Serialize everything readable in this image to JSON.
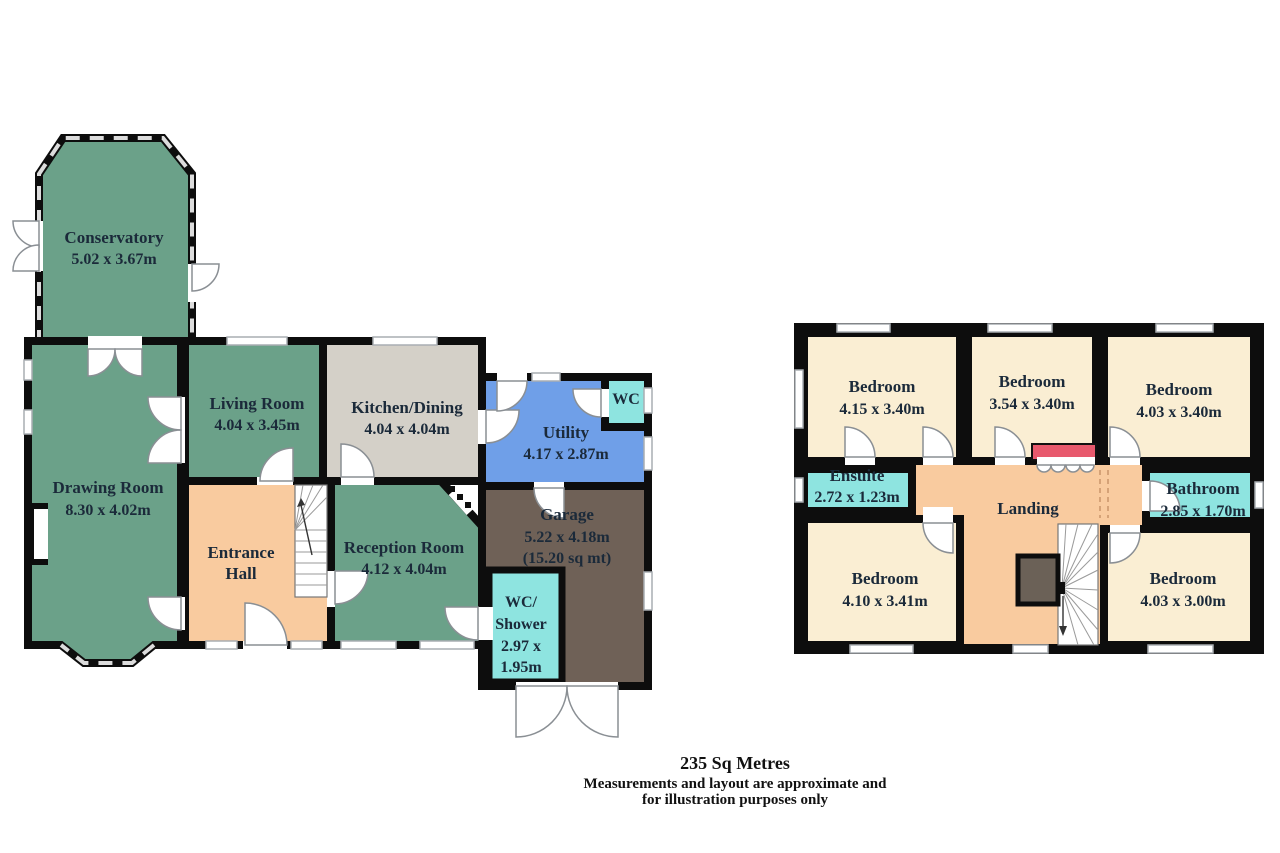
{
  "footer": {
    "area_total": "235 Sq Metres",
    "disclaimer_line1": "Measurements and layout are approximate and",
    "disclaimer_line2": "for illustration purposes only"
  },
  "ground_floor": {
    "conservatory": {
      "name": "Conservatory",
      "dims": "5.02 x 3.67m"
    },
    "drawing_room": {
      "name": "Drawing Room",
      "dims": "8.30 x 4.02m"
    },
    "living_room": {
      "name": "Living Room",
      "dims": "4.04 x 3.45m"
    },
    "kitchen_dining": {
      "name": "Kitchen/Dining",
      "dims": "4.04 x 4.04m"
    },
    "utility": {
      "name": "Utility",
      "dims": "4.17 x 2.87m"
    },
    "wc": {
      "name": "WC"
    },
    "entrance_hall": {
      "name_line1": "Entrance",
      "name_line2": "Hall"
    },
    "reception_room": {
      "name": "Reception Room",
      "dims": "4.12 x 4.04m"
    },
    "garage": {
      "name": "Garage",
      "dims": "5.22 x 4.18m",
      "area": "(15.20 sq mt)"
    },
    "wc_shower": {
      "name_line1": "WC/",
      "name_line2": "Shower",
      "dims_line1": "2.97 x",
      "dims_line2": "1.95m"
    }
  },
  "first_floor": {
    "bedroom_top_left": {
      "name": "Bedroom",
      "dims": "4.15 x 3.40m"
    },
    "bedroom_top_middle": {
      "name": "Bedroom",
      "dims": "3.54 x 3.40m"
    },
    "bedroom_top_right": {
      "name": "Bedroom",
      "dims": "4.03 x 3.40m"
    },
    "ensuite": {
      "name": "Ensuite",
      "dims": "2.72 x 1.23m"
    },
    "landing": {
      "name": "Landing"
    },
    "bathroom": {
      "name": "Bathroom",
      "dims": "2.85 x 1.70m"
    },
    "bedroom_bottom_left": {
      "name": "Bedroom",
      "dims": "4.10 x 3.41m"
    },
    "bedroom_bottom_right": {
      "name": "Bedroom",
      "dims": "4.03 x 3.00m"
    }
  },
  "colors": {
    "green": "#6ba189",
    "kitchen_gray": "#d4d0c8",
    "utility_blue": "#6f9fe8",
    "cyan": "#8ee4e0",
    "peach": "#f9cb9f",
    "garage_brown": "#6f6157",
    "bedroom_cream": "#faeed3",
    "wardrobe_red": "#e8596d",
    "cupboard_gray": "#6b6157",
    "wall_black": "#0d0d0d"
  }
}
